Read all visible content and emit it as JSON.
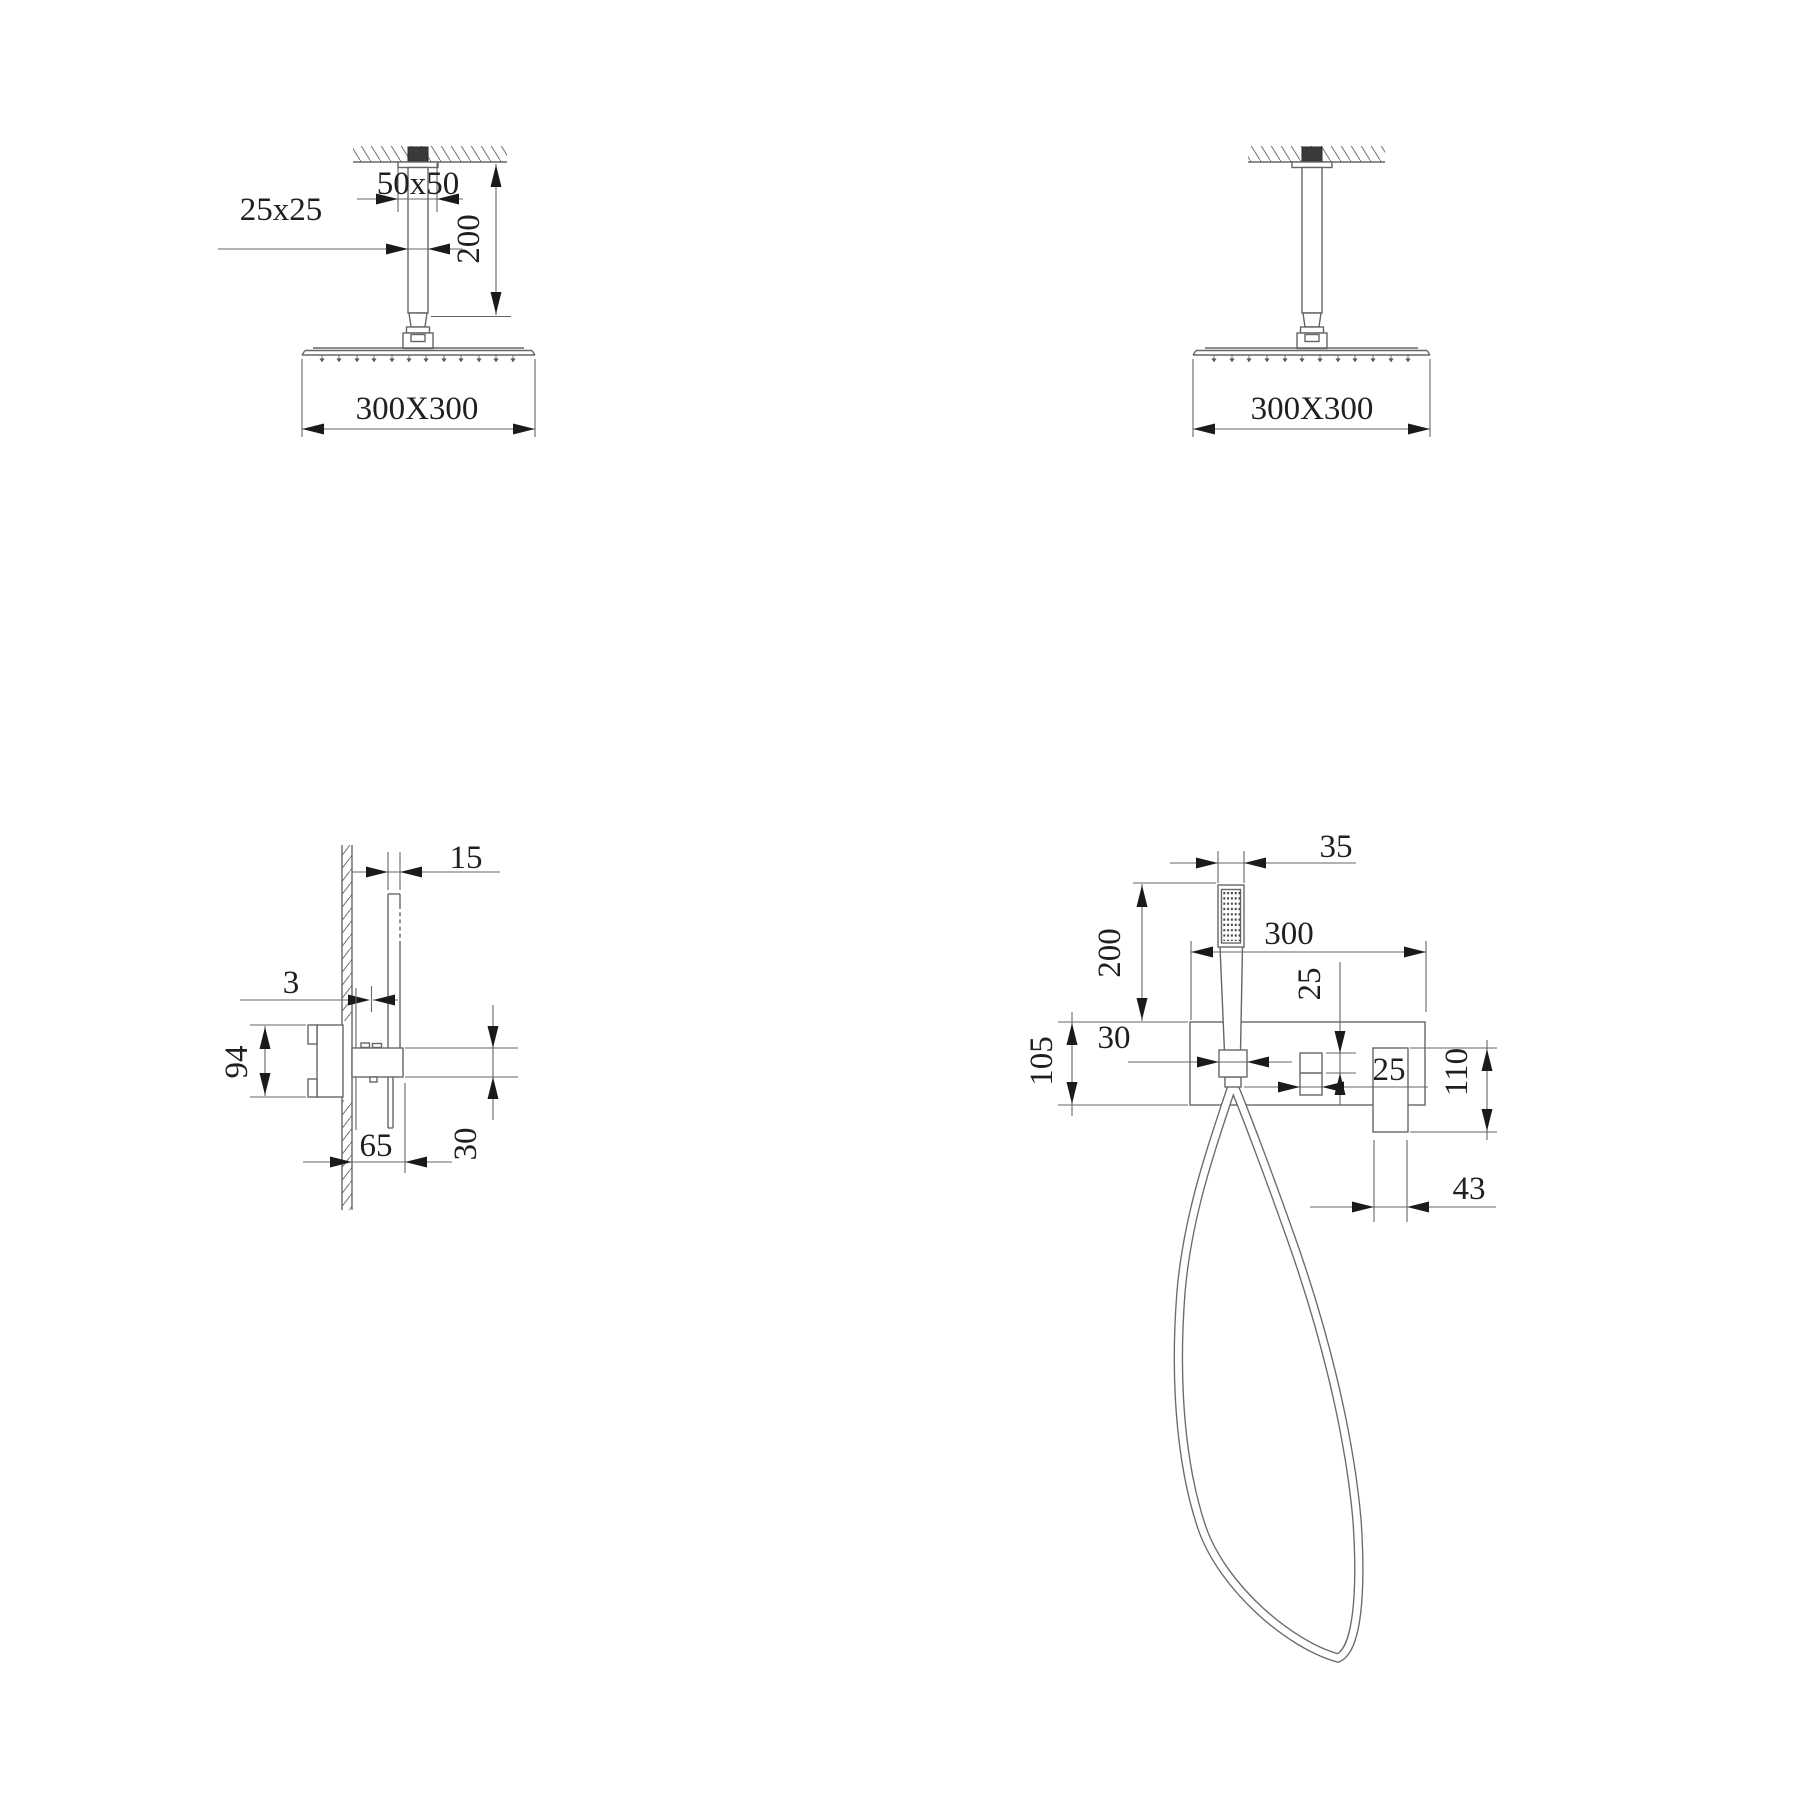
{
  "colors": {
    "background": "#ffffff",
    "line": "#666666",
    "text": "#1f1f1f",
    "arrow": "#1a1a1a",
    "mount_fill": "#3a3a3a"
  },
  "diagrams": {
    "ceiling_left": {
      "title": "ceiling rain shower with arm - dimensioned",
      "labels": {
        "flange": "50x50",
        "arm": "25x25",
        "drop": "200",
        "head": "300X300"
      }
    },
    "ceiling_right": {
      "title": "ceiling rain shower",
      "labels": {
        "head": "300X300"
      }
    },
    "valve_side": {
      "title": "wall valve side view",
      "labels": {
        "handshower": "15",
        "gap": "3",
        "body": "94",
        "spout": "65",
        "spout_height": "30"
      }
    },
    "valve_front": {
      "title": "wall valve front view with hand shower",
      "labels": {
        "handshower": "35",
        "drop": "200",
        "plate_width": "300",
        "outlet_offset": "25",
        "holder": "30",
        "plate_height": "105",
        "outlet": "25",
        "elbow": "110",
        "elbow_width": "43"
      }
    }
  }
}
